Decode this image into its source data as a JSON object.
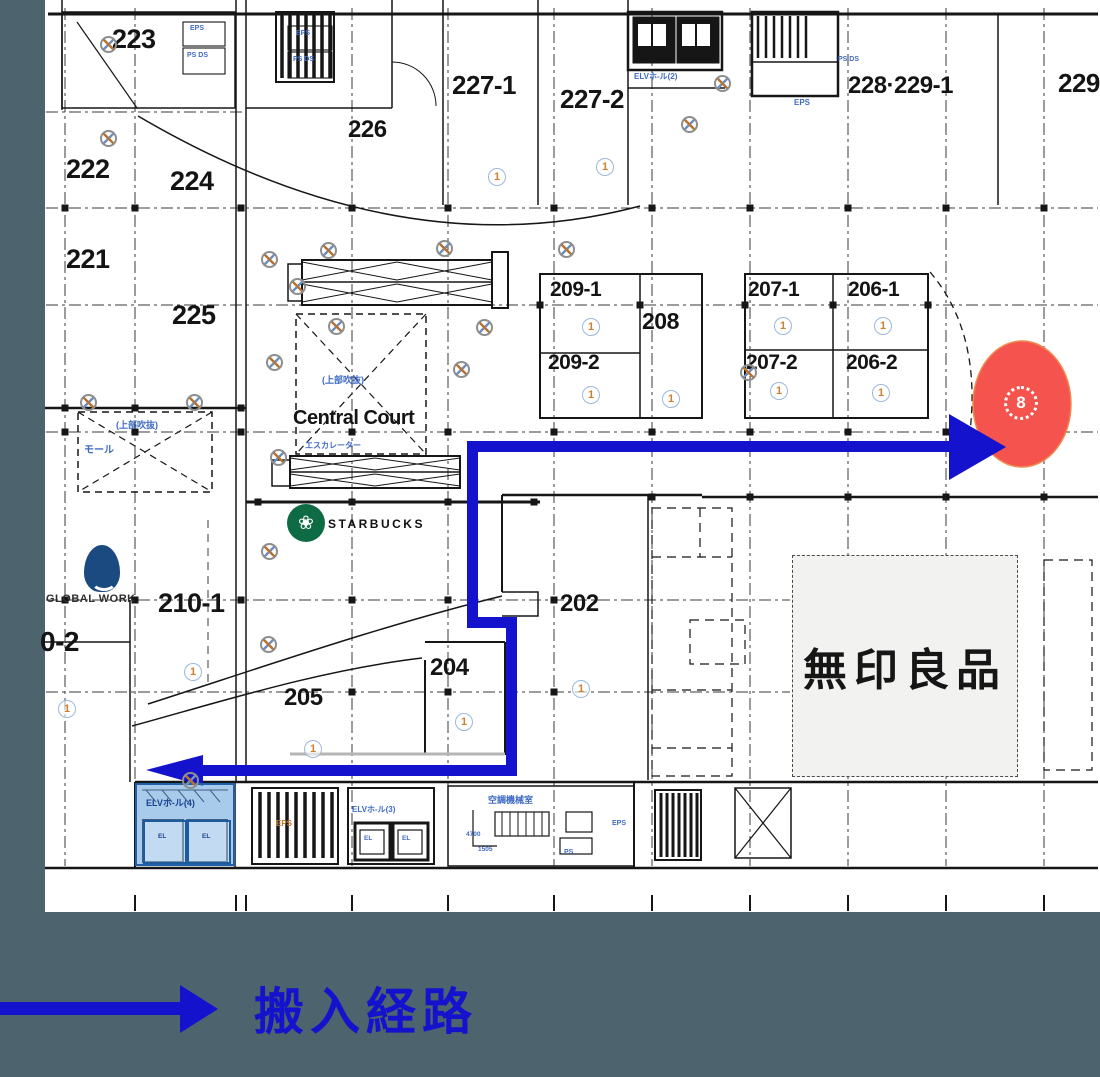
{
  "colors": {
    "route_blue": "#1512cd",
    "marker_red": "#f4544d",
    "marker_edge": "#ef8a50",
    "slate_bg": "#4d636e",
    "plan_bg": "#ffffff",
    "cad_blue": "#3f6ac4",
    "highlight_fill": "rgba(96,160,220,0.55)",
    "highlight_border": "#2060a8",
    "muji_bg": "#f2f3f1",
    "starbucks_green": "#0e6b44",
    "global_work_navy": "#1b4a80",
    "orange_label": "#c4762e"
  },
  "legend": {
    "label": "搬入経路"
  },
  "marker": {
    "glyph": "8"
  },
  "brands": {
    "starbucks": {
      "name": "STARBUCKS",
      "logo_glyph": "❀"
    },
    "global_work": {
      "name": "GLOBAL WORK"
    },
    "muji": {
      "name": "無印良品"
    }
  },
  "room_labels": [
    {
      "t": "223",
      "x": 112,
      "y": 26,
      "s": 27
    },
    {
      "t": "226",
      "x": 348,
      "y": 118,
      "s": 24
    },
    {
      "t": "222",
      "x": 66,
      "y": 156,
      "s": 27
    },
    {
      "t": "224",
      "x": 170,
      "y": 168,
      "s": 27
    },
    {
      "t": "221",
      "x": 66,
      "y": 246,
      "s": 27
    },
    {
      "t": "225",
      "x": 172,
      "y": 302,
      "s": 27
    },
    {
      "t": "227-1",
      "x": 452,
      "y": 72,
      "s": 26
    },
    {
      "t": "227-2",
      "x": 560,
      "y": 86,
      "s": 26
    },
    {
      "t": "228·229-1",
      "x": 848,
      "y": 74,
      "s": 24
    },
    {
      "t": "229",
      "x": 1058,
      "y": 70,
      "s": 26
    },
    {
      "t": "209-1",
      "x": 550,
      "y": 279,
      "s": 21
    },
    {
      "t": "208",
      "x": 642,
      "y": 310,
      "s": 23
    },
    {
      "t": "209-2",
      "x": 548,
      "y": 352,
      "s": 21
    },
    {
      "t": "207-1",
      "x": 748,
      "y": 279,
      "s": 21
    },
    {
      "t": "206-1",
      "x": 848,
      "y": 279,
      "s": 21
    },
    {
      "t": "207-2",
      "x": 746,
      "y": 352,
      "s": 21
    },
    {
      "t": "206-2",
      "x": 846,
      "y": 352,
      "s": 21
    },
    {
      "t": "Central Court",
      "x": 293,
      "y": 408,
      "s": 20
    },
    {
      "t": "210-1",
      "x": 158,
      "y": 590,
      "s": 27
    },
    {
      "t": "0-2",
      "x": 40,
      "y": 628,
      "s": 28
    },
    {
      "t": "202",
      "x": 560,
      "y": 592,
      "s": 24
    },
    {
      "t": "204",
      "x": 430,
      "y": 656,
      "s": 24
    },
    {
      "t": "205",
      "x": 284,
      "y": 686,
      "s": 24
    }
  ],
  "small_labels": [
    {
      "t": "EPS",
      "x": 190,
      "y": 25,
      "s": 7
    },
    {
      "t": "PS DS",
      "x": 187,
      "y": 52,
      "s": 7
    },
    {
      "t": "EPS",
      "x": 296,
      "y": 30,
      "s": 7
    },
    {
      "t": "PS DS",
      "x": 293,
      "y": 56,
      "s": 7
    },
    {
      "t": "ELVホ-ル(2)",
      "x": 634,
      "y": 73,
      "s": 8
    },
    {
      "t": "PS DS",
      "x": 838,
      "y": 56,
      "s": 7
    },
    {
      "t": "EPS",
      "x": 794,
      "y": 99,
      "s": 8
    },
    {
      "t": "(上部吹抜)",
      "x": 116,
      "y": 421,
      "s": 9
    },
    {
      "t": "モール",
      "x": 84,
      "y": 446,
      "s": 10
    },
    {
      "t": "(上部吹抜)",
      "x": 322,
      "y": 376,
      "s": 9
    },
    {
      "t": "エスカレーター",
      "x": 305,
      "y": 442,
      "s": 8
    },
    {
      "t": "ELVホ-ル(4)",
      "x": 146,
      "y": 799,
      "s": 9,
      "c": "#1a4390"
    },
    {
      "t": "EL",
      "x": 158,
      "y": 834,
      "s": 6.5,
      "c": "#1a4390"
    },
    {
      "t": "EL",
      "x": 202,
      "y": 834,
      "s": 6.5,
      "c": "#1a4390"
    },
    {
      "t": "ELVホ-ル(3)",
      "x": 352,
      "y": 806,
      "s": 8
    },
    {
      "t": "EL",
      "x": 364,
      "y": 836,
      "s": 6.5
    },
    {
      "t": "EL",
      "x": 402,
      "y": 836,
      "s": 6.5
    },
    {
      "t": "空調機械室",
      "x": 488,
      "y": 796,
      "s": 9
    },
    {
      "t": "EPS",
      "x": 612,
      "y": 820,
      "s": 7
    },
    {
      "t": "PS",
      "x": 564,
      "y": 849,
      "s": 7
    },
    {
      "t": "4700",
      "x": 466,
      "y": 832,
      "s": 6.5
    },
    {
      "t": "1505",
      "x": 478,
      "y": 847,
      "s": 6.5
    },
    {
      "t": "EPS",
      "x": 276,
      "y": 820,
      "s": 8,
      "c": "#c4762e"
    }
  ],
  "symbols": {
    "circled_one": "1"
  },
  "circled_one_positions": [
    [
      488,
      168
    ],
    [
      596,
      158
    ],
    [
      582,
      318
    ],
    [
      662,
      390
    ],
    [
      582,
      386
    ],
    [
      774,
      317
    ],
    [
      874,
      317
    ],
    [
      770,
      382
    ],
    [
      872,
      384
    ],
    [
      184,
      663
    ],
    [
      572,
      680
    ],
    [
      455,
      713
    ],
    [
      304,
      740
    ],
    [
      58,
      700
    ]
  ],
  "sprinkler_positions": [
    [
      100,
      36
    ],
    [
      100,
      130
    ],
    [
      261,
      251
    ],
    [
      289,
      278
    ],
    [
      266,
      354
    ],
    [
      270,
      449
    ],
    [
      80,
      394
    ],
    [
      186,
      394
    ],
    [
      320,
      242
    ],
    [
      436,
      240
    ],
    [
      558,
      241
    ],
    [
      328,
      318
    ],
    [
      476,
      319
    ],
    [
      453,
      361
    ],
    [
      714,
      75
    ],
    [
      681,
      116
    ],
    [
      740,
      364
    ],
    [
      182,
      772
    ],
    [
      261,
      543
    ],
    [
      260,
      636
    ]
  ]
}
